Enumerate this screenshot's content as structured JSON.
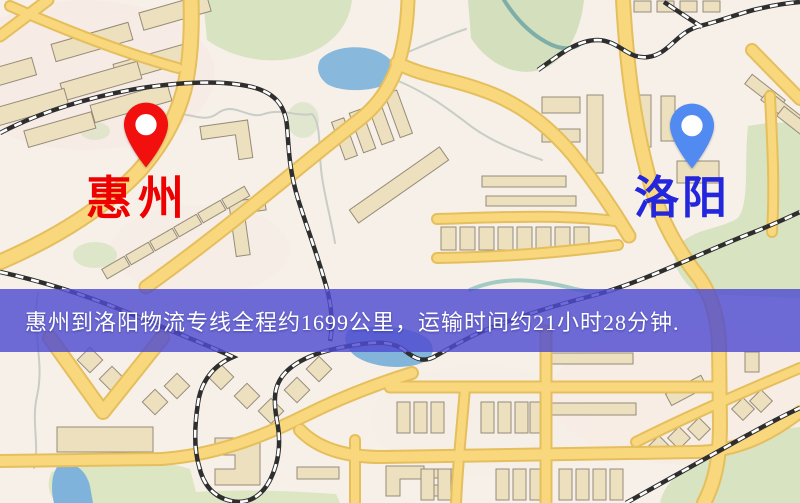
{
  "map": {
    "origin": {
      "label": "惠州",
      "pin_color": "#F2100F",
      "label_color": "#EE0000"
    },
    "destination": {
      "label": "洛阳",
      "pin_color": "#518BF2",
      "label_color": "#2326DC"
    },
    "info_banner": {
      "text": "惠州到洛阳物流专线全程约1699公里，运输时间约21小时28分钟.",
      "bg_color": "rgba(79,76,209,0.82)",
      "text_color": "#FFFFFF"
    },
    "route": {
      "from": "惠州",
      "to": "洛阳",
      "distance_text": "约1699公里",
      "duration_text": "约21小时28分钟"
    }
  }
}
